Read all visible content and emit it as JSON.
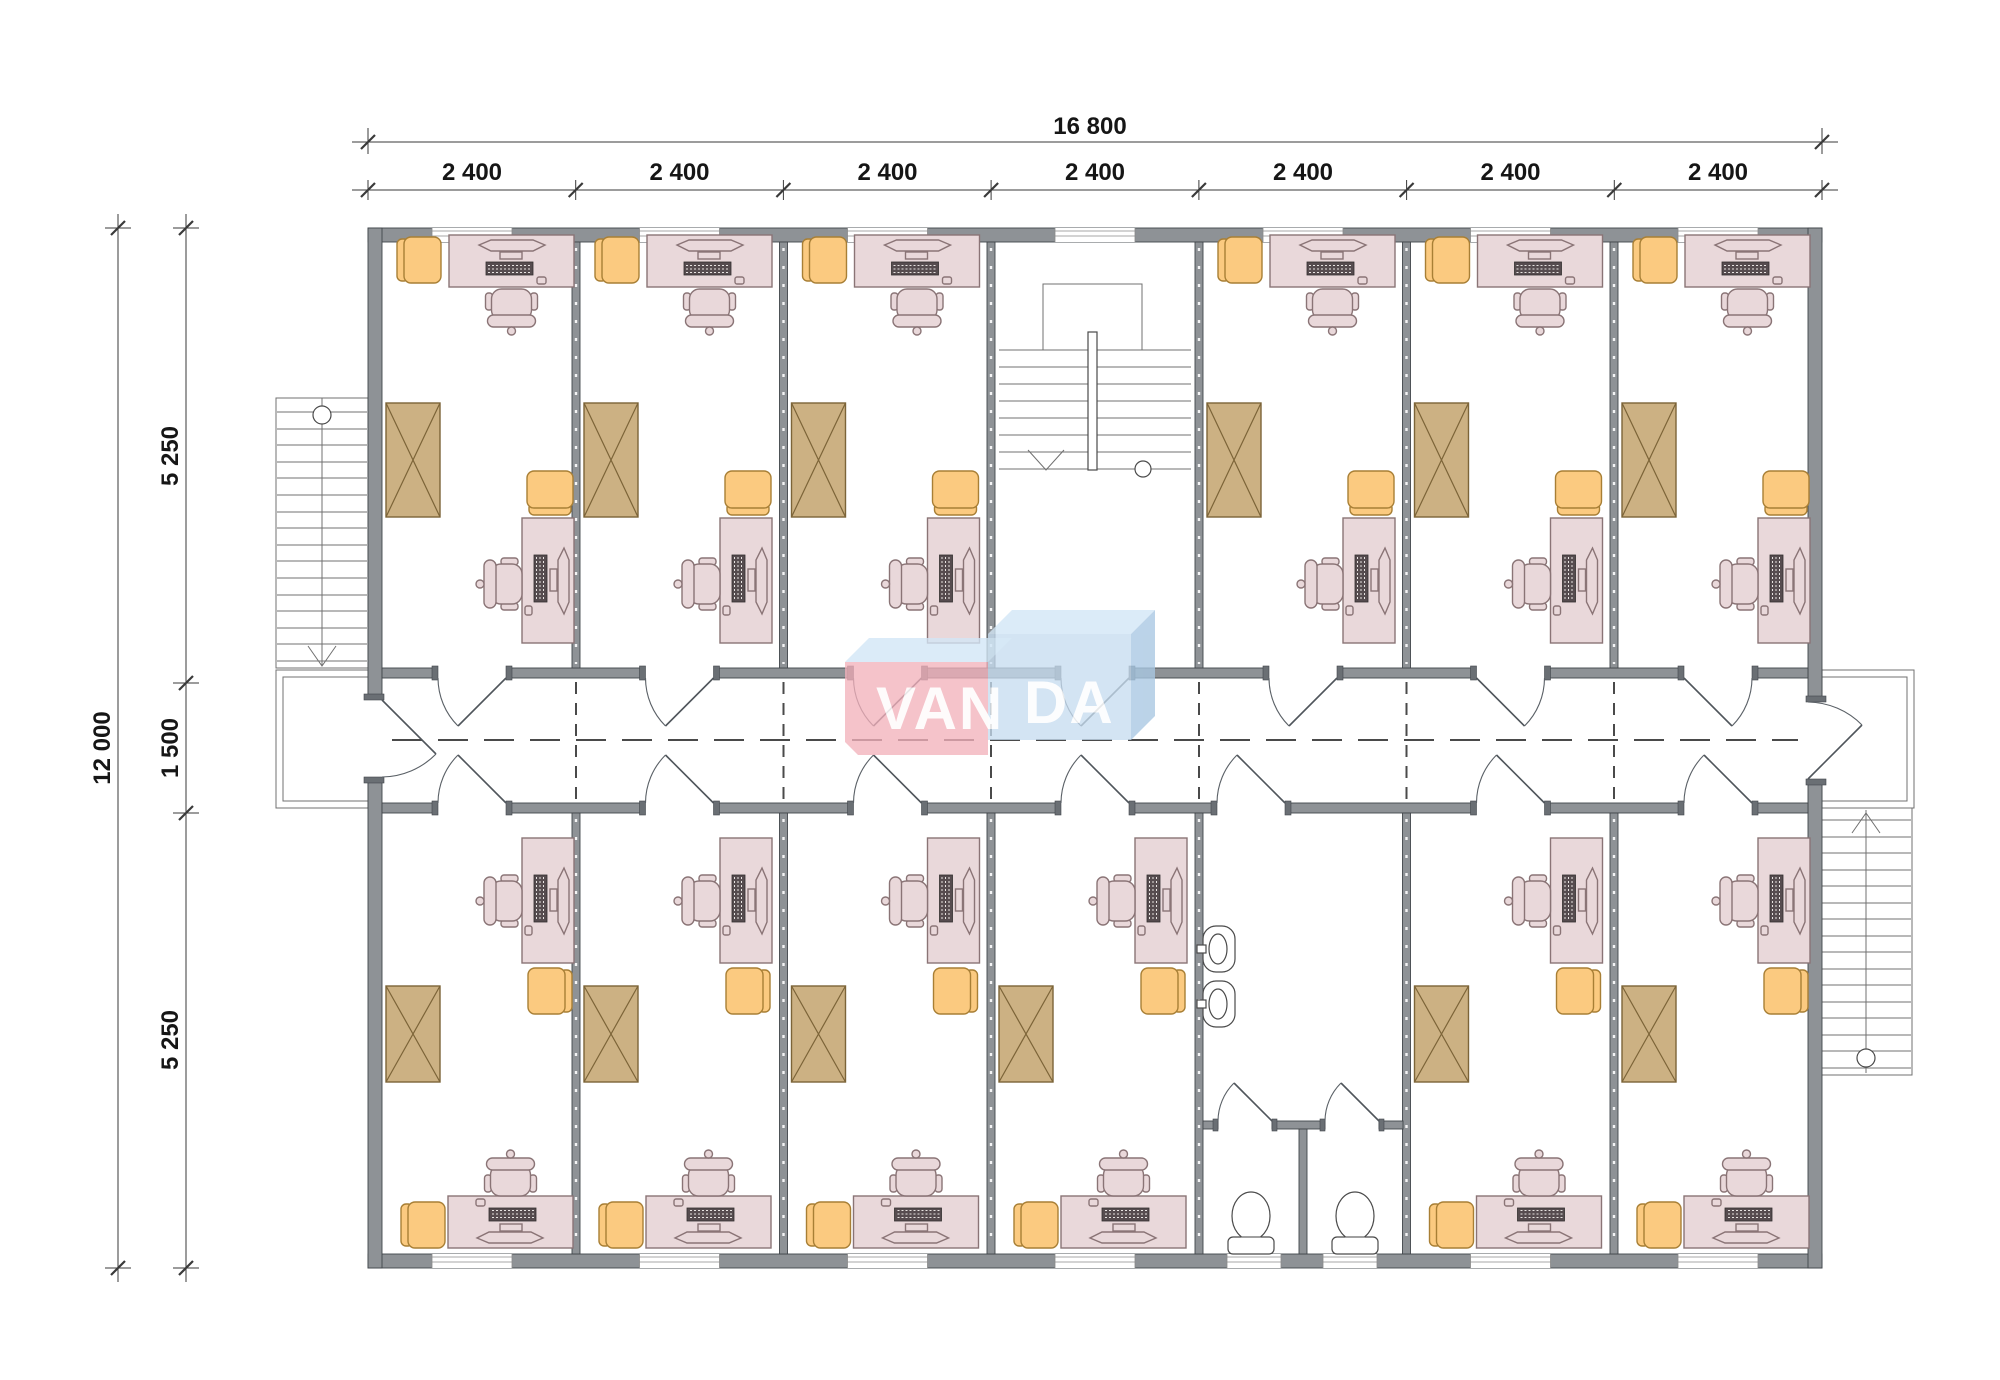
{
  "title": "modular building floor plan",
  "dimensions": {
    "top_total": "16 800",
    "top_segments": [
      "2 400",
      "2 400",
      "2 400",
      "2 400",
      "2 400",
      "2 400",
      "2 400"
    ],
    "left_total": "12 000",
    "left_segments": [
      "5 250",
      "1 500",
      "5 250"
    ]
  },
  "logo": {
    "text": "VANDA",
    "left_text": "VAN",
    "right_text": "DA",
    "front_pink": "#f3b0bb",
    "front_blue": "#c6dcef",
    "top_face": "#d2e5f5",
    "side_fold": "#a9c8e2",
    "letter_color": "#ffffff"
  },
  "plan": {
    "rooms": {
      "offices_top_row": 6,
      "offices_bottom_row": 6,
      "central_stairwell": 1,
      "bathroom_with_two_wc_stalls": 1,
      "corridor": 1,
      "exterior_stairs": 2
    },
    "icons": [
      "desk-with-computer-icon",
      "office-chair-icon",
      "side-chair-icon",
      "wardrobe-crossed-icon",
      "sink-icon",
      "toilet-icon",
      "staircase-icon",
      "door-swing-icon",
      "window-icon"
    ],
    "colors": {
      "walls": "#8e9296",
      "furniture_pink": "#e9d8da",
      "seat_orange": "#fbca80",
      "wardrobe_tan": "#ccb183",
      "lines": "#4a4a4a"
    }
  }
}
